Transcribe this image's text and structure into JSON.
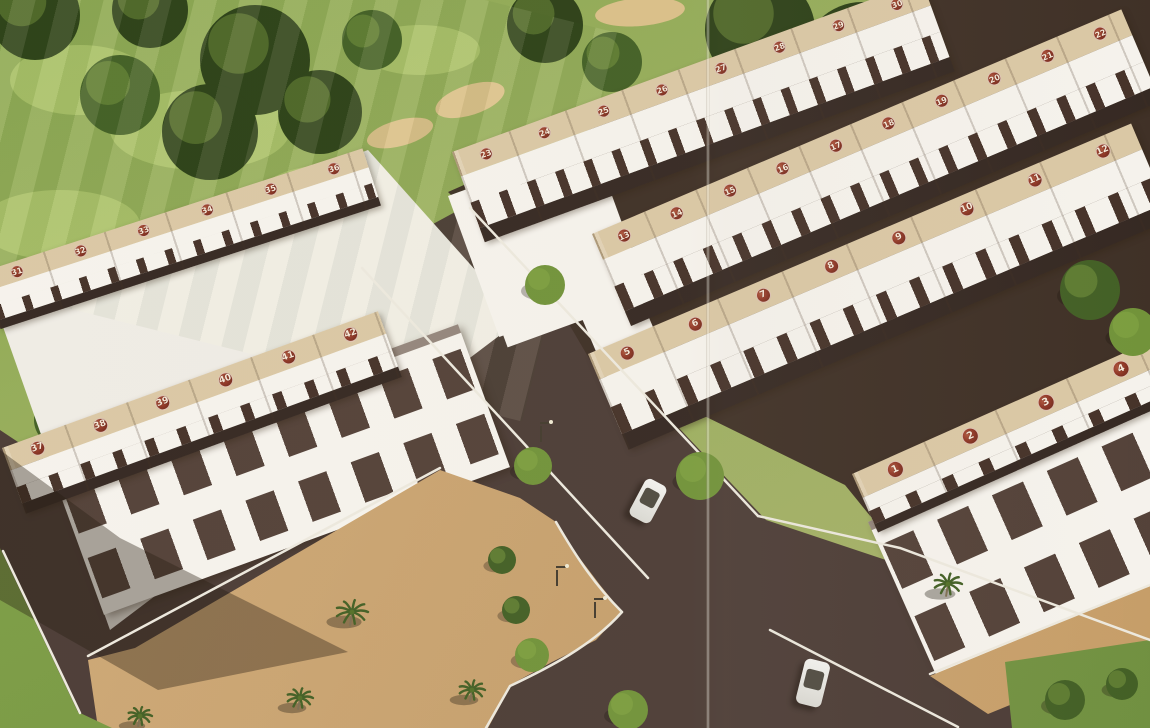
{
  "scene_title": "aerial-rendering-townhouse-development",
  "colors": {
    "roof": "#d9c6a2",
    "wallwhite": "#f5f2ec",
    "window": "#3f2b22",
    "rowshadow": "#2e211b",
    "road": "#463630",
    "roaddark": "#38291f",
    "curb": "#ece8dd",
    "sandlight": "#d9bd85",
    "treedark": "#24390f",
    "treemid": "#3c5a1e",
    "treelight": "#6c8f33",
    "badgebg": "#8d3120",
    "badgetext": "#f7e8d8"
  },
  "crease_x": 708,
  "rows": [
    {
      "id": "left-back",
      "x": -18,
      "y": 272,
      "len": 400,
      "depth": 60,
      "angle": -18,
      "roof_h": 20,
      "badge": 13,
      "sep": 64,
      "winw": 8,
      "winp": 30,
      "badges": [
        31,
        32,
        33,
        34,
        35,
        36
      ]
    },
    {
      "id": "left-front",
      "x": 2,
      "y": 448,
      "len": 400,
      "depth": 70,
      "angle": -20,
      "roof_h": 24,
      "badge": 15,
      "sep": 66,
      "winw": 10,
      "winp": 34,
      "badges": [
        37,
        38,
        39,
        40,
        41,
        42
      ]
    },
    {
      "id": "mid-back",
      "x": 452,
      "y": 152,
      "len": 500,
      "depth": 96,
      "angle": -20,
      "roof_h": 26,
      "badge": 13,
      "sep": 60,
      "winw": 9,
      "winp": 30,
      "badges": [
        23,
        24,
        25,
        26,
        27,
        28,
        29,
        30
      ]
    },
    {
      "id": "mid-center",
      "x": 592,
      "y": 234,
      "len": 575,
      "depth": 100,
      "angle": -23,
      "roof_h": 28,
      "badge": 14,
      "sep": 56,
      "winw": 10,
      "winp": 32,
      "badges": [
        13,
        14,
        15,
        16,
        17,
        18,
        19,
        20,
        21,
        22
      ]
    },
    {
      "id": "mid-front",
      "x": 588,
      "y": 354,
      "len": 590,
      "depth": 104,
      "angle": -23,
      "roof_h": 28,
      "badge": 15,
      "sep": 70,
      "winw": 11,
      "winp": 36,
      "badges": [
        5,
        6,
        7,
        8,
        9,
        10,
        11,
        12
      ]
    },
    {
      "id": "right-front",
      "x": 852,
      "y": 474,
      "len": 330,
      "depth": 64,
      "angle": -24,
      "roof_h": 26,
      "badge": 17,
      "sep": 78,
      "winw": 12,
      "winp": 40,
      "badges": [
        1,
        2,
        3,
        4
      ]
    }
  ],
  "facades": [
    {
      "id": "left",
      "x": 52,
      "y": 472,
      "len": 432,
      "depth": 152,
      "angle": -20,
      "floors": 2,
      "winw": 30,
      "winp": 56
    },
    {
      "id": "right",
      "x": 868,
      "y": 522,
      "len": 320,
      "depth": 172,
      "angle": -24,
      "floors": 2,
      "winw": 34,
      "winp": 60
    }
  ],
  "gables": [
    {
      "x": 448,
      "y": 196,
      "w": 72,
      "h": 150,
      "angle": -20
    },
    {
      "x": 470,
      "y": 244,
      "w": 150,
      "h": 110,
      "angle": -20
    },
    {
      "x": 575,
      "y": 302,
      "w": 62,
      "h": 120,
      "angle": -23
    }
  ],
  "trees_bg": [
    {
      "x": 35,
      "y": 15,
      "r": 45,
      "c": "treedark"
    },
    {
      "x": 150,
      "y": 10,
      "r": 38,
      "c": "treedark"
    },
    {
      "x": 255,
      "y": 60,
      "r": 55,
      "c": "treedark"
    },
    {
      "x": 210,
      "y": 132,
      "r": 48,
      "c": "treedark"
    },
    {
      "x": 120,
      "y": 95,
      "r": 40,
      "c": "treemid"
    },
    {
      "x": 320,
      "y": 112,
      "r": 42,
      "c": "treedark"
    },
    {
      "x": 372,
      "y": 40,
      "r": 30,
      "c": "treemid"
    },
    {
      "x": 545,
      "y": 25,
      "r": 38,
      "c": "treedark"
    },
    {
      "x": 612,
      "y": 62,
      "r": 30,
      "c": "treemid"
    },
    {
      "x": 760,
      "y": 30,
      "r": 55,
      "c": "treedark"
    },
    {
      "x": 862,
      "y": 62,
      "r": 60,
      "c": "treedark"
    },
    {
      "x": 950,
      "y": 30,
      "r": 55,
      "c": "treedark"
    },
    {
      "x": 1040,
      "y": 20,
      "r": 45,
      "c": "treedark"
    },
    {
      "x": 1120,
      "y": 10,
      "r": 40,
      "c": "treedark"
    },
    {
      "x": 1012,
      "y": 112,
      "r": 48,
      "c": "treedark"
    },
    {
      "x": 1105,
      "y": 92,
      "r": 35,
      "c": "treemid"
    },
    {
      "x": 932,
      "y": 132,
      "r": 40,
      "c": "treedark"
    },
    {
      "x": 1138,
      "y": 182,
      "r": 35,
      "c": "treedark"
    },
    {
      "x": 10,
      "y": 492,
      "r": 45,
      "c": "treedark"
    },
    {
      "x": 60,
      "y": 420,
      "r": 26,
      "c": "treemid"
    }
  ],
  "trees_fg": [
    {
      "x": 545,
      "y": 285,
      "r": 20,
      "c": "treelight"
    },
    {
      "x": 533,
      "y": 466,
      "r": 19,
      "c": "treelight"
    },
    {
      "x": 502,
      "y": 560,
      "r": 14,
      "c": "treemid"
    },
    {
      "x": 516,
      "y": 610,
      "r": 14,
      "c": "treemid"
    },
    {
      "x": 532,
      "y": 655,
      "r": 17,
      "c": "treelight"
    },
    {
      "x": 628,
      "y": 710,
      "r": 20,
      "c": "treelight"
    },
    {
      "x": 700,
      "y": 476,
      "r": 24,
      "c": "treelight"
    },
    {
      "x": 1090,
      "y": 290,
      "r": 30,
      "c": "treemid"
    },
    {
      "x": 1133,
      "y": 332,
      "r": 24,
      "c": "treelight"
    },
    {
      "x": 1065,
      "y": 700,
      "r": 20,
      "c": "treemid"
    },
    {
      "x": 1122,
      "y": 684,
      "r": 16,
      "c": "treemid"
    }
  ],
  "palms": [
    {
      "x": 352,
      "y": 612,
      "s": 16
    },
    {
      "x": 300,
      "y": 698,
      "s": 13
    },
    {
      "x": 472,
      "y": 690,
      "s": 13
    },
    {
      "x": 948,
      "y": 584,
      "s": 14
    },
    {
      "x": 140,
      "y": 716,
      "s": 12
    }
  ],
  "bunkers": [
    {
      "x": 400,
      "y": 133,
      "rx": 34,
      "ry": 13,
      "rot": -15
    },
    {
      "x": 470,
      "y": 100,
      "rx": 36,
      "ry": 15,
      "rot": -18
    },
    {
      "x": 640,
      "y": 12,
      "rx": 45,
      "ry": 14,
      "rot": -5
    },
    {
      "x": 1090,
      "y": 122,
      "rx": 45,
      "ry": 6,
      "rot": -8
    }
  ],
  "light_patches": [
    {
      "x": 200,
      "y": 130,
      "rx": 90,
      "ry": 40
    },
    {
      "x": 80,
      "y": 80,
      "rx": 70,
      "ry": 35
    },
    {
      "x": 420,
      "y": 50,
      "rx": 60,
      "ry": 25
    },
    {
      "x": 330,
      "y": 195,
      "rx": 70,
      "ry": 30
    },
    {
      "x": 60,
      "y": 225,
      "rx": 80,
      "ry": 35
    },
    {
      "x": 160,
      "y": 305,
      "rx": 120,
      "ry": 45
    },
    {
      "x": 1080,
      "y": 70,
      "rx": 55,
      "ry": 30
    }
  ],
  "cars": [
    {
      "x": 636,
      "y": 480,
      "w": 24,
      "h": 42,
      "angle": 28
    },
    {
      "x": 800,
      "y": 660,
      "w": 26,
      "h": 46,
      "angle": 14
    }
  ],
  "lamps": [
    {
      "x": 556,
      "y": 568
    },
    {
      "x": 594,
      "y": 600
    },
    {
      "x": 540,
      "y": 424
    }
  ],
  "road_paths": {
    "main": "M352,268 L468,205 L766,520 L1150,648 L1150,728 L60,728 L0,560 L0,430 L60,470 Z",
    "backdrop_right": "M448,192 L910,-12 L1150,-12 L1150,545 L945,608 L845,485 L590,360 L552,295 Z",
    "backdrop_left": "M-10,290 L368,150 L520,320 L110,630 Z"
  },
  "curbs": [
    "M362,268 L648,578",
    "M470,208 L758,516",
    "M556,522 C578,560 596,586 622,612",
    "M622,612 C592,646 548,668 510,686 L486,728",
    "M88,656 L440,468",
    "M3,551 L80,713",
    "M770,630 L958,727",
    "M758,516 L900,548 L1150,640",
    "M930,674 L1150,585"
  ]
}
